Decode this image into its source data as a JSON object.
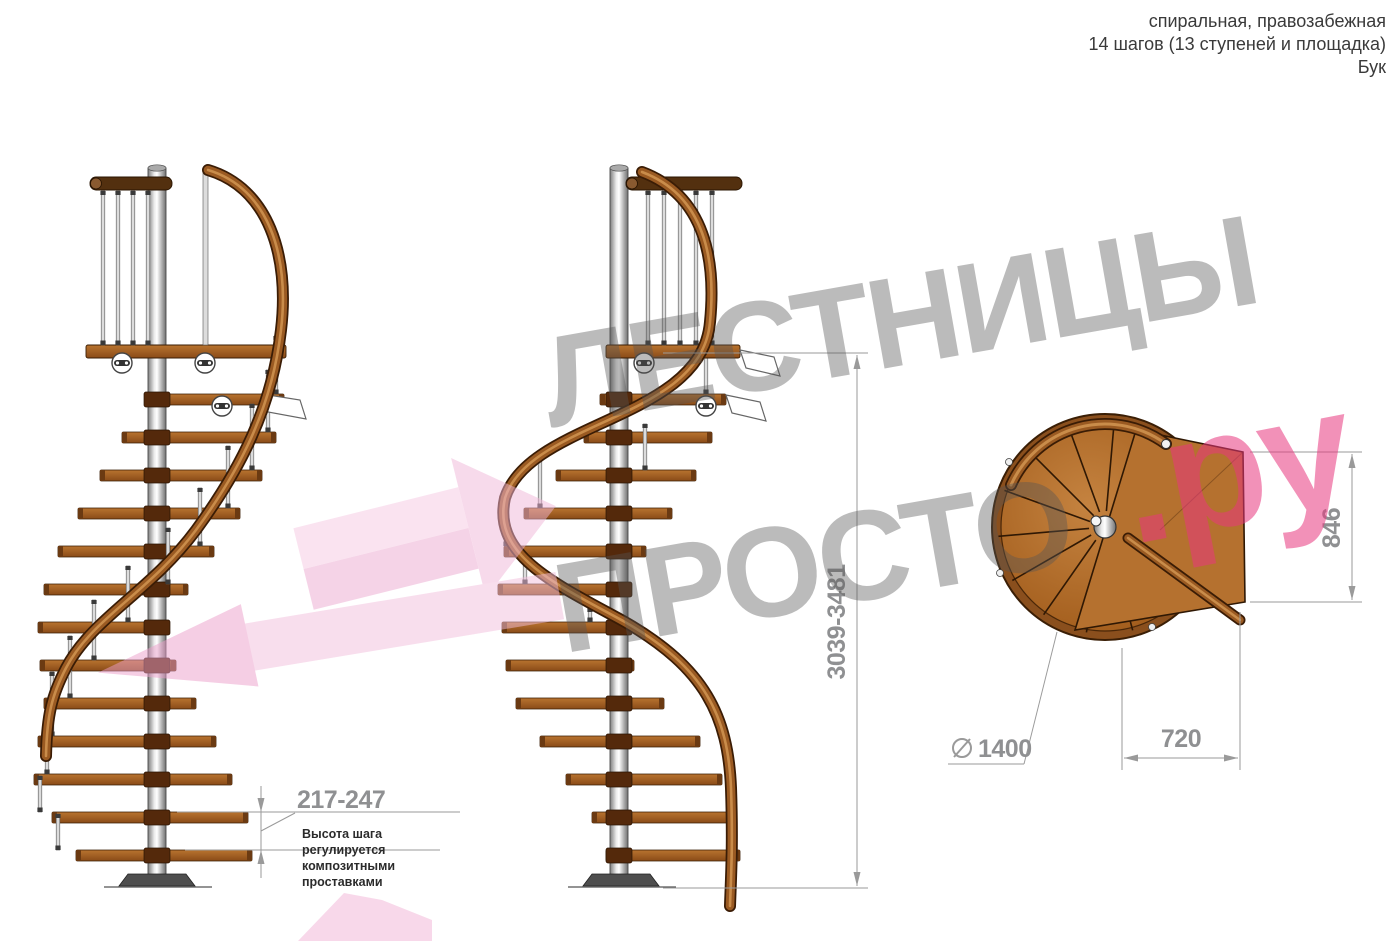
{
  "header": {
    "line1": "спиральная, правозабежная",
    "line2": "14 шагов (13 ступеней и площадка)",
    "line3": "Бук"
  },
  "watermark": {
    "brand_word_top": "ЛЕСТНИЦЫ",
    "brand_word_bottom": "ПРОСТО",
    "brand_suffix": ".ру"
  },
  "dimensions": {
    "total_height": "3039-3481",
    "step_height": "217-247",
    "platform_depth": "846",
    "platform_width": "720",
    "diameter_value": "1400"
  },
  "annotation": {
    "line1": "Высота шага",
    "line2": "регулируется",
    "line3": "композитными",
    "line4": "проставками"
  },
  "colors": {
    "accent_pink": "#e73b7d",
    "dim_gray": "#8f9092",
    "wood": "#a05a22"
  }
}
